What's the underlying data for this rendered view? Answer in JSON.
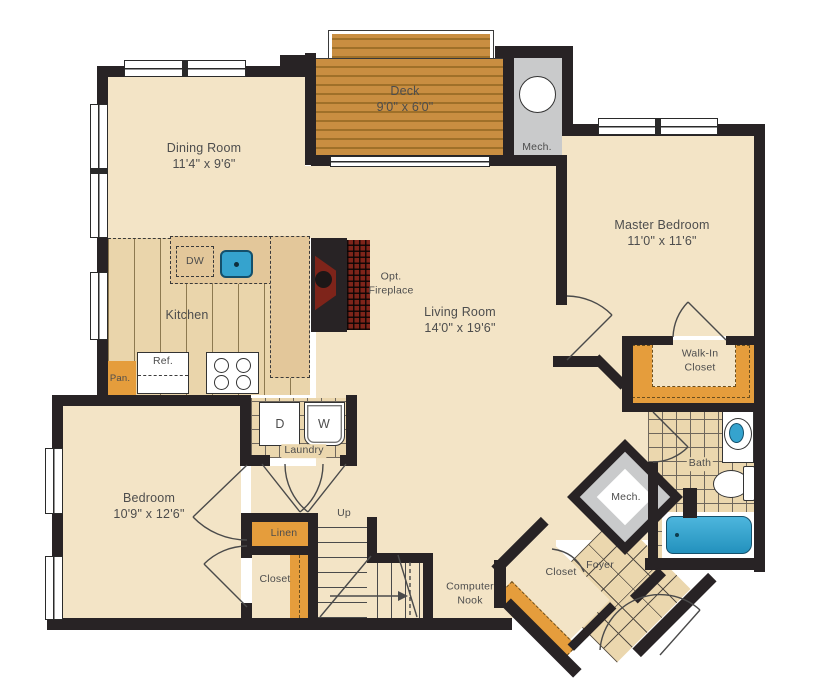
{
  "palette": {
    "floor_cream": "#F3E4C6",
    "deck_wood": "#C98E41",
    "kitchen_floor": "#EAD5AB",
    "counter": "#E3C79A",
    "accent_orange": "#E59D3C",
    "tile": "#EBD7AE",
    "mech_gray": "#C9CACB",
    "fixture_blue": "#35A3CE",
    "fireplace_red": "#7E241A",
    "wall": "#282325",
    "text": "#4D4D4D"
  },
  "rooms": {
    "deck": {
      "name": "Deck",
      "dims": "9'0\" x 6'0\""
    },
    "dining": {
      "name": "Dining Room",
      "dims": "11'4\" x 9'6\""
    },
    "master": {
      "name": "Master Bedroom",
      "dims": "11'0\" x 11'6\""
    },
    "kitchen": {
      "name": "Kitchen"
    },
    "living": {
      "name": "Living Room",
      "dims": "14'0\" x 19'6\""
    },
    "bedroom": {
      "name": "Bedroom",
      "dims": "10'9\" x 12'6\""
    },
    "walk_in_closet": {
      "line1": "Walk-In",
      "line2": "Closet"
    },
    "bath": {
      "name": "Bath"
    },
    "laundry": {
      "name": "Laundry"
    },
    "linen": {
      "name": "Linen"
    },
    "bedroom_closet": {
      "name": "Closet"
    },
    "foyer": {
      "name": "Foyer"
    },
    "foyer_closet": {
      "name": "Closet"
    },
    "computer_nook": {
      "line1": "Computer",
      "line2": "Nook"
    },
    "stairs": {
      "label": "Up"
    },
    "mech_upper": {
      "name": "Mech."
    },
    "mech_foyer": {
      "name": "Mech."
    },
    "fireplace": {
      "line1": "Opt.",
      "line2": "Fireplace"
    }
  },
  "appliances": {
    "dishwasher": "DW",
    "refrigerator": "Ref.",
    "pantry": "Pan.",
    "dryer": "D",
    "washer": "W"
  }
}
